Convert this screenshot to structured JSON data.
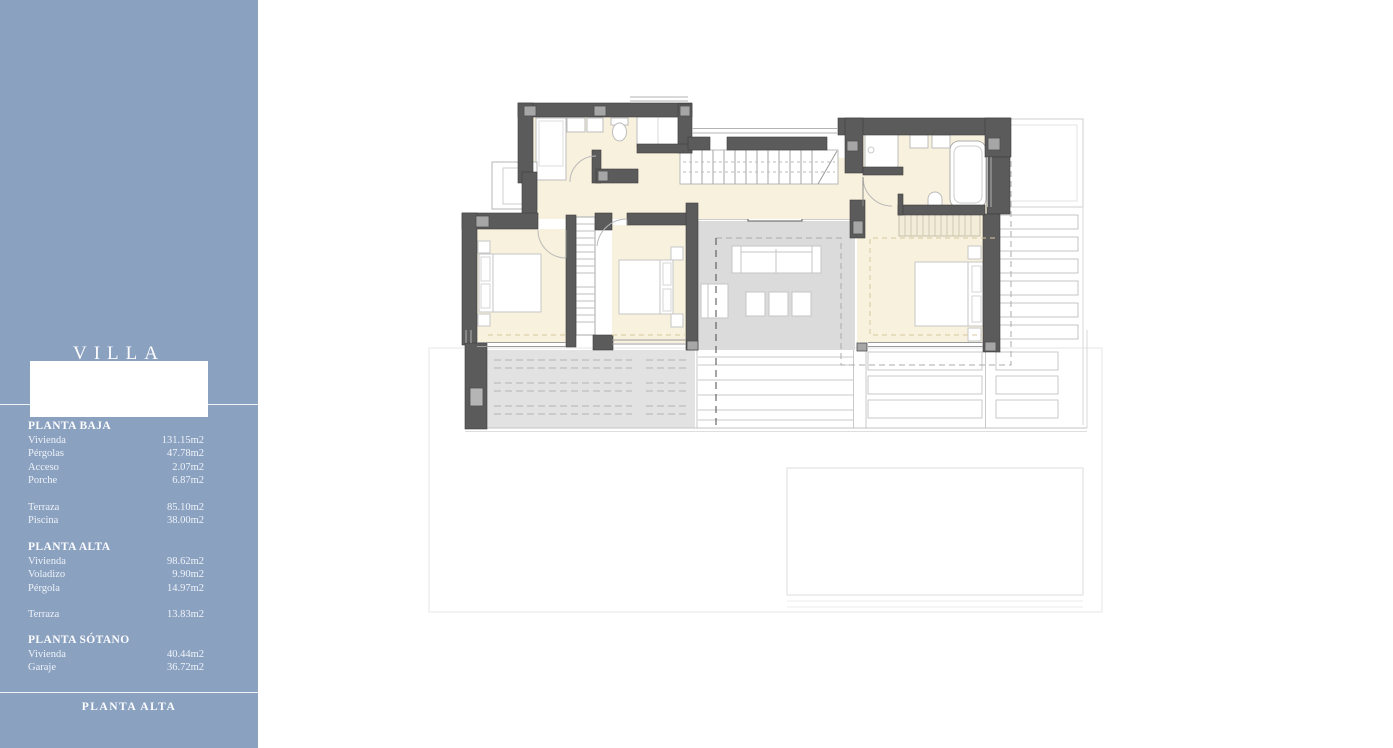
{
  "sidebar": {
    "title": "VILLA",
    "footer": "PLANTA ALTA",
    "bg_color": "#8ba1c0",
    "sections": [
      {
        "title": "PLANTA BAJA",
        "items": [
          {
            "label": "Vivienda",
            "value": "131.15m2"
          },
          {
            "label": "Pérgolas",
            "value": "47.78m2"
          },
          {
            "label": "Acceso",
            "value": "2.07m2"
          },
          {
            "label": "Porche",
            "value": "6.87m2"
          }
        ],
        "extra": [
          {
            "label": "Terraza",
            "value": "85.10m2"
          },
          {
            "label": "Piscina",
            "value": "38.00m2"
          }
        ]
      },
      {
        "title": "PLANTA ALTA",
        "items": [
          {
            "label": "Vivienda",
            "value": "98.62m2"
          },
          {
            "label": "Voladizo",
            "value": "9.90m2"
          },
          {
            "label": "Pérgola",
            "value": "14.97m2"
          }
        ],
        "extra": [
          {
            "label": "Terraza",
            "value": "13.83m2"
          }
        ]
      },
      {
        "title": "PLANTA SÓTANO",
        "items": [
          {
            "label": "Vivienda",
            "value": "40.44m2"
          },
          {
            "label": "Garaje",
            "value": "36.72m2"
          }
        ],
        "extra": []
      }
    ]
  },
  "plan": {
    "floor_shown": "PLANTA ALTA",
    "colors": {
      "wall": "#5b5b5b",
      "column": "#a6a6a6",
      "interior_floor": "#f8f1dd",
      "terrace": "#dbdbdb",
      "deck": "#e2e2e2",
      "overhang_dash_tan": "#d8c7a0",
      "section_dash": "#4a4a4a",
      "pergola_dash": "#ababab"
    }
  }
}
